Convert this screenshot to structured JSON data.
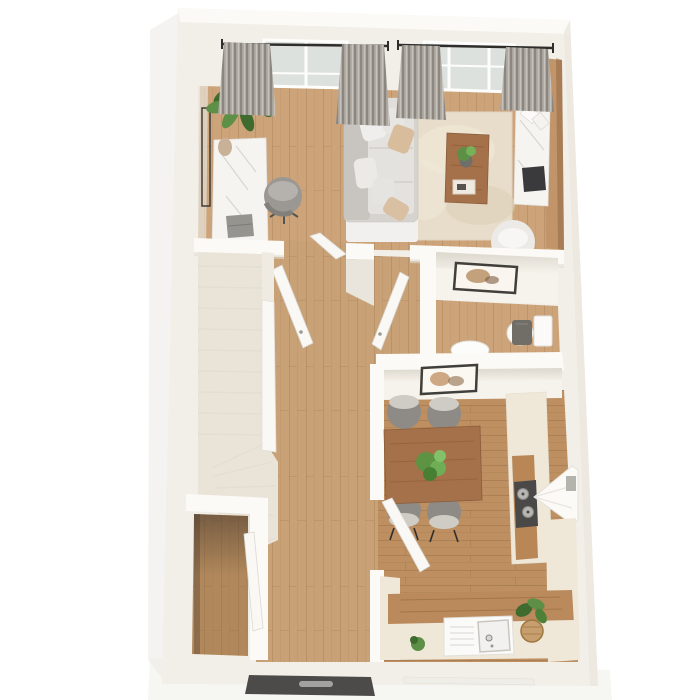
{
  "scene": {
    "type": "3d-floor-plan-render",
    "view": "top-down dollhouse perspective, single storey",
    "rooms": [
      {
        "name": "living-room",
        "position": "top",
        "contents": [
          "window-wall-with-curtains",
          "curtain-rod",
          "potted-plant",
          "marble-desk",
          "laptop",
          "office-chair",
          "sofa-with-pillows",
          "area-rug",
          "coffee-table",
          "coffee-table-plant",
          "decor-tray",
          "wood-accent-wall",
          "marble-media-console",
          "tv",
          "magazines",
          "armchair",
          "floor-lamp-frame"
        ]
      },
      {
        "name": "hallway",
        "position": "center",
        "contents": [
          "open-door-left",
          "open-door-right",
          "door-leaf-living-side"
        ]
      },
      {
        "name": "staircase",
        "position": "center-left",
        "contents": [
          "carpeted-treads",
          "winder-treads",
          "railing-wall"
        ]
      },
      {
        "name": "under-stair-closet",
        "position": "bottom-left",
        "contents": [
          "closet-door",
          "wood-floor"
        ]
      },
      {
        "name": "wc",
        "position": "middle-right",
        "contents": [
          "wall-art",
          "toilet",
          "wash-basin"
        ]
      },
      {
        "name": "kitchen-dining",
        "position": "bottom-right",
        "contents": [
          "wall-art",
          "dining-table",
          "plant-centerpiece",
          "dining-chair-1",
          "dining-chair-2",
          "dining-chair-3",
          "dining-chair-4",
          "tall-counter",
          "wood-worktop",
          "cooktop",
          "extractor-hood",
          "bottom-counter",
          "kitchen-sink",
          "faucet",
          "small-plant",
          "basket-plant",
          "kitchen-door"
        ]
      }
    ],
    "exterior": [
      "front-door",
      "entry-step",
      "building-shadow"
    ]
  },
  "colors": {
    "background": "#ffffff",
    "wall_face": "#f2efe8",
    "wall_top": "#fbfaf6",
    "wall_shadow": "#e2ded4",
    "wall_inner": "#f6f3ec",
    "floor_living": "#cda47a",
    "floor_hall": "#c9a176",
    "floor_kitchen": "#bd8f61",
    "floor_closet": "#b1885b",
    "stair_carpet": "#eae4d8",
    "rug": "#e7ddca",
    "marble": "#f5f4f1",
    "counter_cream": "#efe8d9",
    "accent_wood": "#c2946a",
    "wood_table": "#a5714a",
    "white_furniture": "#f9f8f5",
    "window_glass": "#dde1dd",
    "sofa_body": "#d6d3cf",
    "sofa_seat": "#e4e2de",
    "sofa_back": "#c8c5c1",
    "pillow_white": "#efeeec",
    "pillow_beige": "#d8bd9d",
    "office_chair": "#9b9792",
    "dining_chair": "#8e8a85",
    "dining_chair_light": "#cfccc6",
    "plant_green": "#5d8f46",
    "plant_dark": "#3f6b2f",
    "dark_metal": "#3e3c39",
    "steel": "#b7b6b3",
    "stove_top": "#4a4947",
    "toilet_lid": "#716d67",
    "front_door": "#4c4b49",
    "basket": "#c79e6d",
    "curtain_base": "#a9a49c",
    "curtain_dark": "#8b867f",
    "curtain_light": "#c6c2bb"
  }
}
